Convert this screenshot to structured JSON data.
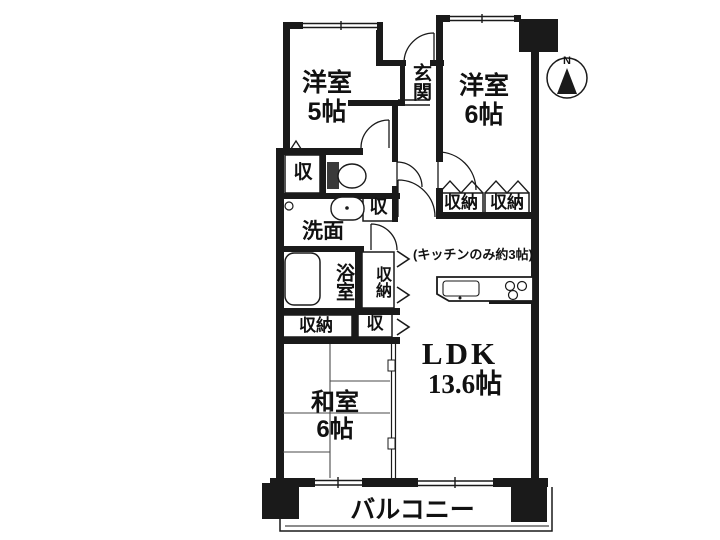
{
  "rooms": {
    "western5": {
      "name": "洋室",
      "size": "5帖"
    },
    "western6": {
      "name": "洋室",
      "size": "6帖"
    },
    "japanese": {
      "name": "和室",
      "size": "6帖"
    },
    "ldk": {
      "name": "LDK",
      "size": "13.6帖"
    },
    "entrance": {
      "name": "玄関"
    },
    "washroom": {
      "name": "洗面"
    },
    "bathroom": {
      "name": "浴室"
    },
    "balcony": {
      "name": "バルコニー"
    }
  },
  "storage": {
    "upper_left_closet": "収",
    "hall_closet": "収",
    "mid_tall_closet": "収納",
    "lower_closet": "収納",
    "lower_small_closet": "収",
    "bedroom6_closet_left": "収納",
    "bedroom6_closet_right": "収納"
  },
  "annotations": {
    "kitchen_note": "(キッチンのみ約3帖)",
    "north_label": "N"
  },
  "colors": {
    "ink": "#1a1a1a",
    "background": "#ffffff"
  }
}
